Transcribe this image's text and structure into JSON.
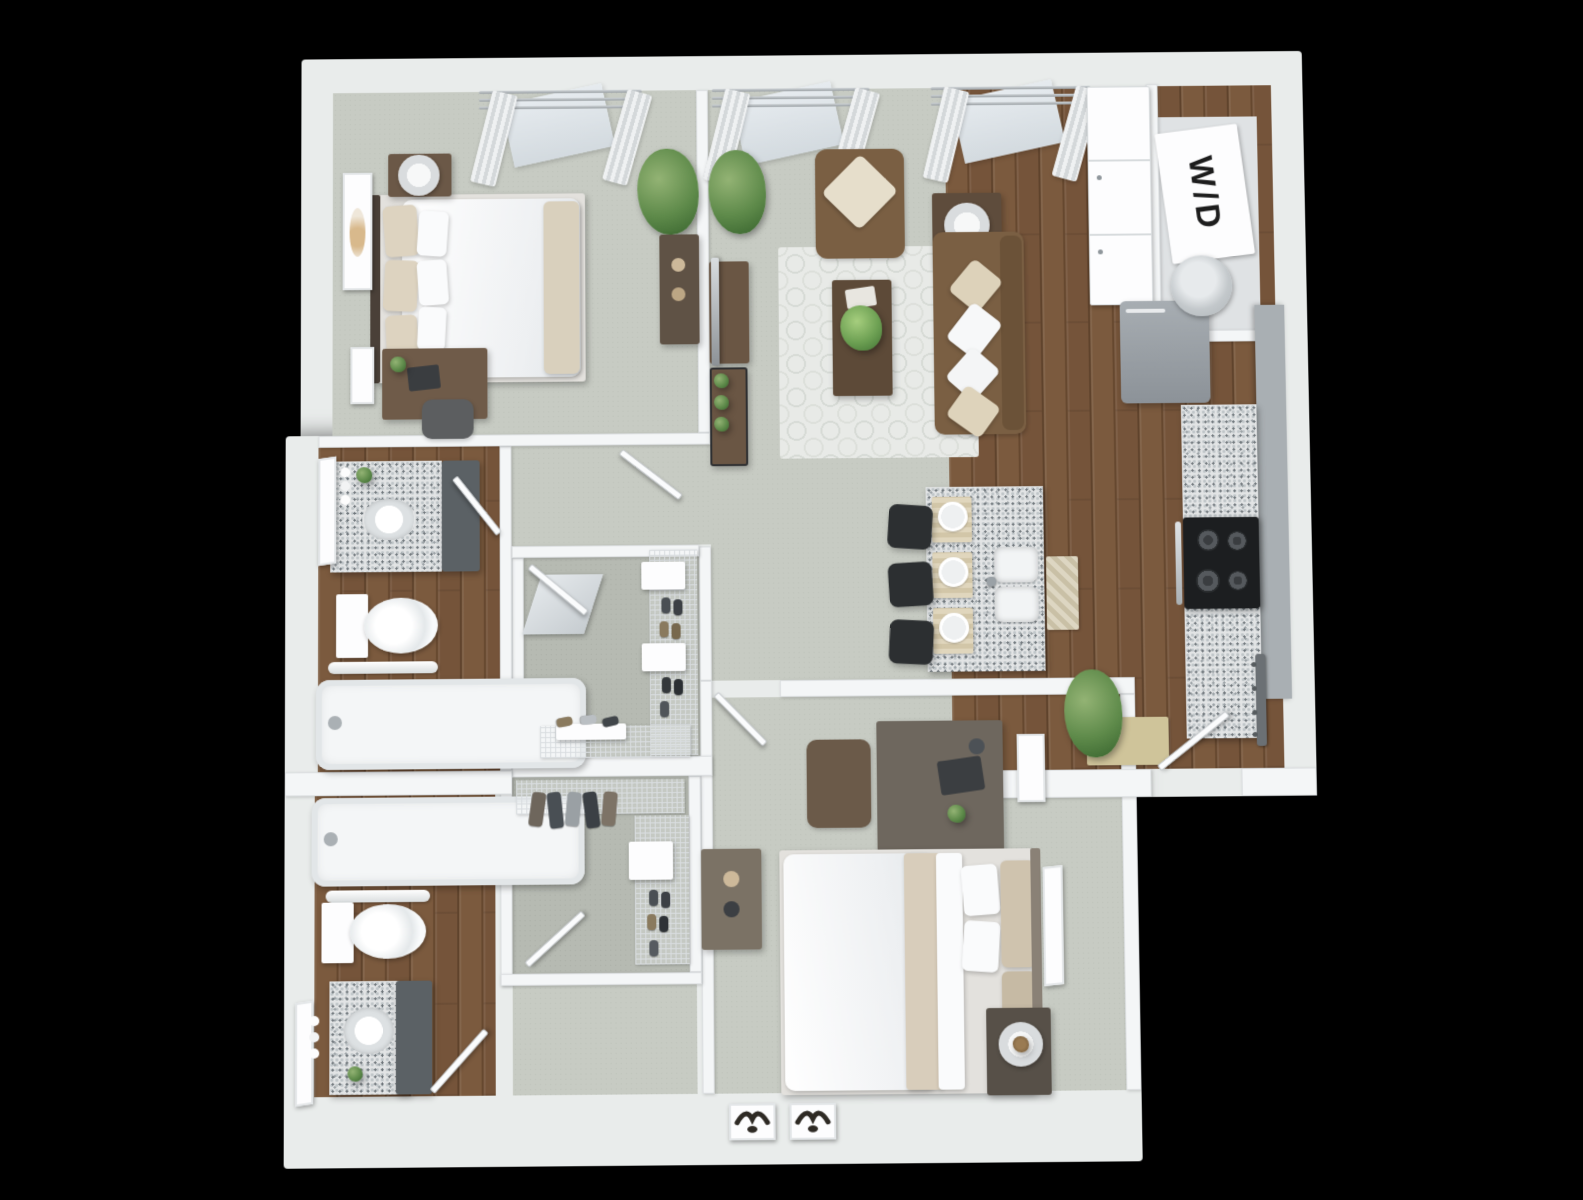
{
  "scene": {
    "description": "3D top-down rendering of a two-bedroom two-bathroom apartment floor plan on a black background",
    "background_color": "#000000",
    "labels": {
      "washer_dryer": "W/D"
    },
    "colors": {
      "walls": "#f4f6f7",
      "carpet": "#c7cbc3",
      "closet_carpet": "#b6bab2",
      "wood_floor": "#75543a",
      "granite_counter": "#e2e4e5",
      "sofa_brown": "#7a5f43",
      "dark_wood_furniture": "#5d4a38",
      "gray_wood_furniture": "#6e675e",
      "bar_stool_black": "#2c2f31",
      "plant_green": "#5e8a4a",
      "area_rug": "#e8eae7",
      "doormat_tan": "#cfc49a"
    },
    "rooms": [
      {
        "name": "Bedroom 1",
        "floor": "carpet",
        "furniture": [
          "queen bed with white duvet",
          "nightstand with cylinder lamp",
          "desk with chair and laptop",
          "2 framed wall art",
          "potted plant",
          "dresser with vases",
          "window curtains"
        ]
      },
      {
        "name": "Living Room",
        "floor": "carpet",
        "furniture": [
          "brown sofa with 4 pillows",
          "brown armchair",
          "dark wood coffee table with plant",
          "quatrefoil area rug",
          "side table with lamp",
          "tv on console",
          "etagere shelf with plants",
          "potted plant",
          "window curtains"
        ]
      },
      {
        "name": "Kitchen",
        "floor": "hardwood",
        "furniture": [
          "white pantry cabinets",
          "refrigerator",
          "granite counter with gray cabinets",
          "stove with 4 burners",
          "granite island",
          "double sink",
          "3 bar stools",
          "3 place settings",
          "chevron runner rug"
        ]
      },
      {
        "name": "Laundry Closet",
        "floor": "hardwood",
        "furniture": [
          "stacked washer dryer labeled W/D",
          "laundry basket"
        ]
      },
      {
        "name": "Bathroom 1",
        "floor": "hardwood",
        "furniture": [
          "granite vanity with sink",
          "leaning mirror",
          "toilet",
          "bathtub",
          "towel bar"
        ]
      },
      {
        "name": "Bathroom 2",
        "floor": "hardwood",
        "furniture": [
          "bathtub",
          "towel bar with towels",
          "toilet",
          "granite vanity with sink",
          "leaning mirror"
        ]
      },
      {
        "name": "Walk-in Closet 1",
        "floor": "carpet",
        "furniture": [
          "wire shelving with shoes",
          "shoe rack",
          "leaning board"
        ]
      },
      {
        "name": "Walk-in Closet 2",
        "floor": "carpet",
        "furniture": [
          "wire shelving",
          "hanging clothes",
          "shoes"
        ]
      },
      {
        "name": "Bedroom 2",
        "floor": "carpet",
        "furniture": [
          "queen bed with white duvet and tan pillows",
          "nightstand with planter",
          "desk with chair and laptop",
          "dresser",
          "leaning art frame",
          "2 bird art frames"
        ]
      },
      {
        "name": "Entry",
        "floor": "hardwood",
        "furniture": [
          "open entry door",
          "coat hook rail",
          "tan doormat",
          "potted plant"
        ]
      }
    ]
  }
}
